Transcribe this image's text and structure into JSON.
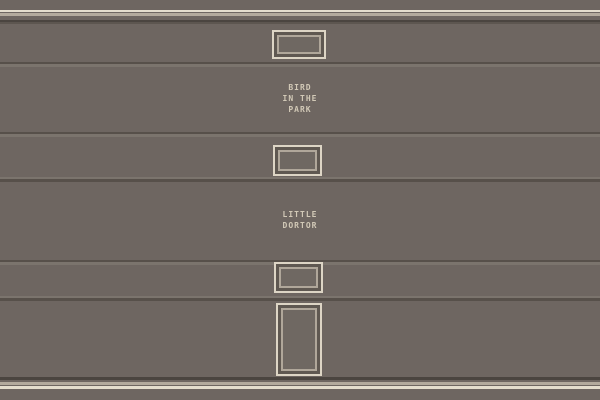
{
  "scene": {
    "colors": {
      "wall": "#6e6661",
      "trim_cream": "#e4ddcd",
      "trim_beige": "#b3aa9d",
      "trim_dark": "#4b4540",
      "trim_dark_soft": "#5d5650",
      "groove_dark": "#57504a",
      "groove_light": "#7b746d",
      "frame_outer": "#ddd5c5",
      "frame_inner": "#b0a79a",
      "frame_gap": "#5f5851",
      "frame_center": "#6f6862",
      "label_text": "#d2c9b7"
    },
    "labels": [
      {
        "id": "bird-in-the-park",
        "lines": [
          "BIRD",
          "IN THE",
          "PARK"
        ]
      },
      {
        "id": "little-dortor",
        "lines": [
          "LITTLE",
          "DORTOR"
        ]
      }
    ],
    "objects": [
      {
        "id": "framed-sign-top"
      },
      {
        "id": "framed-sign-middle"
      },
      {
        "id": "framed-sign-lower"
      },
      {
        "id": "door"
      }
    ]
  }
}
